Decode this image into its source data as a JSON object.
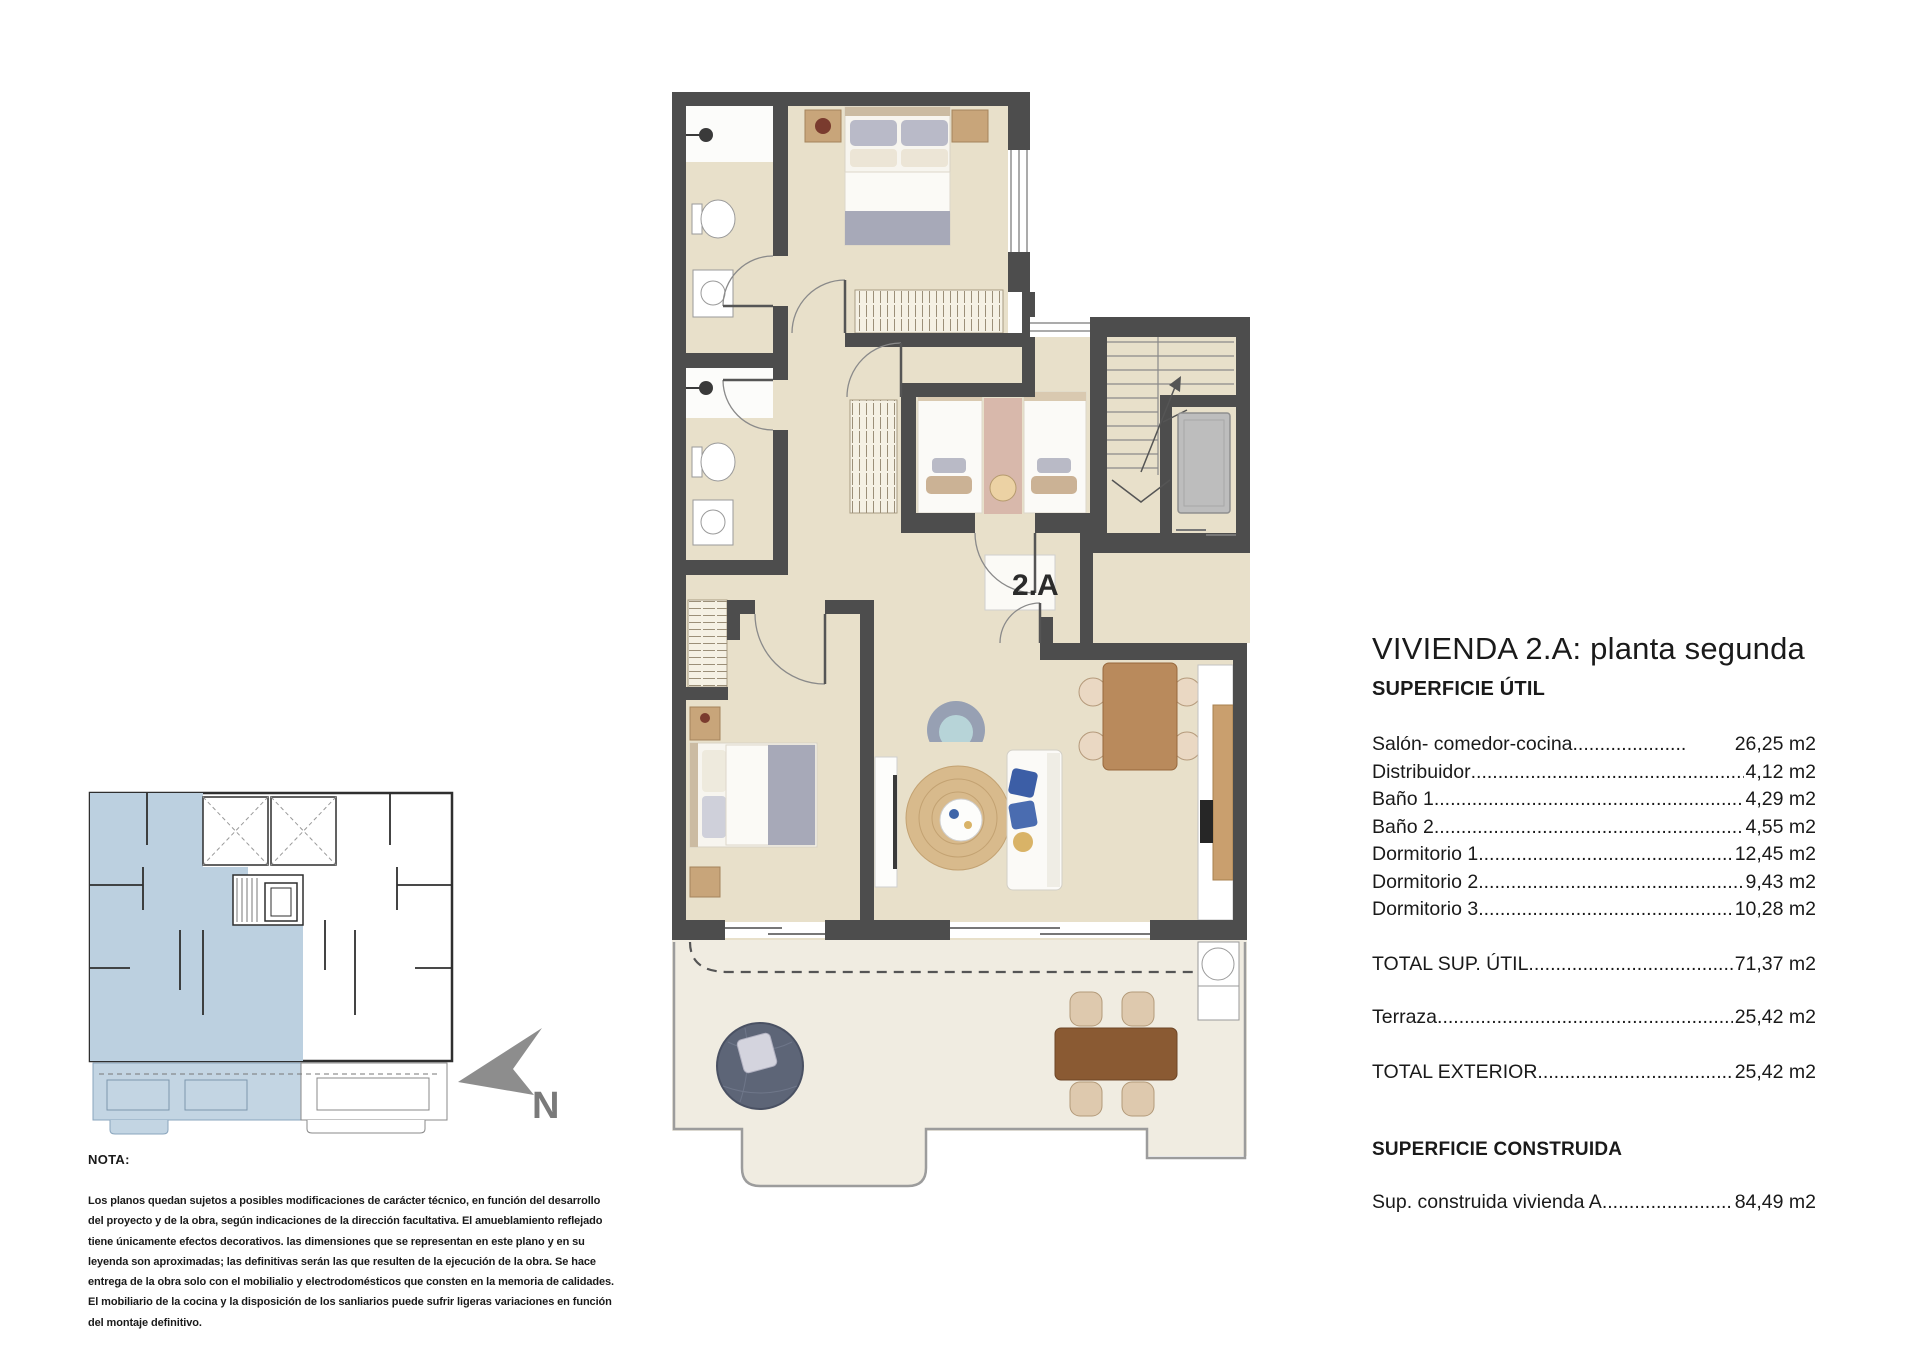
{
  "floor_plan": {
    "unit_label": "2.A"
  },
  "compass": {
    "north_label": "N"
  },
  "colors": {
    "wall": "#4d4d4d",
    "floor": "#e8e0ca",
    "terrace_floor": "#f0ece1",
    "keyplan_highlight": "#bcd0e0"
  },
  "panel": {
    "title": "VIVIENDA 2.A: planta segunda",
    "superficie_util": {
      "heading": "SUPERFICIE ÚTIL",
      "rows": [
        {
          "label": "Salón- comedor-cocina",
          "value": "26,25 m2"
        },
        {
          "label": "Distribuidor",
          "value": "4,12 m2"
        },
        {
          "label": "Baño 1",
          "value": "4,29 m2"
        },
        {
          "label": "Baño 2",
          "value": "4,55 m2"
        },
        {
          "label": "Dormitorio 1",
          "value": "12,45 m2"
        },
        {
          "label": "Dormitorio 2",
          "value": "9,43 m2"
        },
        {
          "label": "Dormitorio 3",
          "value": "10,28 m2"
        }
      ],
      "total": {
        "label": "TOTAL SUP. ÚTIL",
        "value": "71,37 m2"
      }
    },
    "exterior": {
      "rows": [
        {
          "label": "Terraza",
          "value": "25,42 m2"
        }
      ],
      "total": {
        "label": "TOTAL EXTERIOR",
        "value": "25,42 m2"
      }
    },
    "superficie_construida": {
      "heading": "SUPERFICIE CONSTRUIDA",
      "rows": [
        {
          "label": "Sup. construida vivienda A",
          "value": "84,49 m2"
        }
      ]
    }
  },
  "note": {
    "heading": "NOTA:",
    "lines": [
      "Los planos quedan sujetos a posibles modificaciones de carácter técnico, en función del desarrollo",
      "del proyecto y de la obra, según indicaciones de la dirección facultativa. El amueblamiento reflejado",
      "tiene únicamente efectos decorativos. las dimensiones que se representan en este plano y en su",
      "leyenda son aproximadas; las definitivas serán las que resulten de la ejecución de la obra. Se hace",
      "entrega de la obra solo con el mobilialio y electrodomésticos que consten en la memoria de calidades.",
      "El mobiliario de la cocina y la disposición de los sanliarios puede sufrir ligeras variaciones en función",
      "del montaje definitivo."
    ]
  }
}
